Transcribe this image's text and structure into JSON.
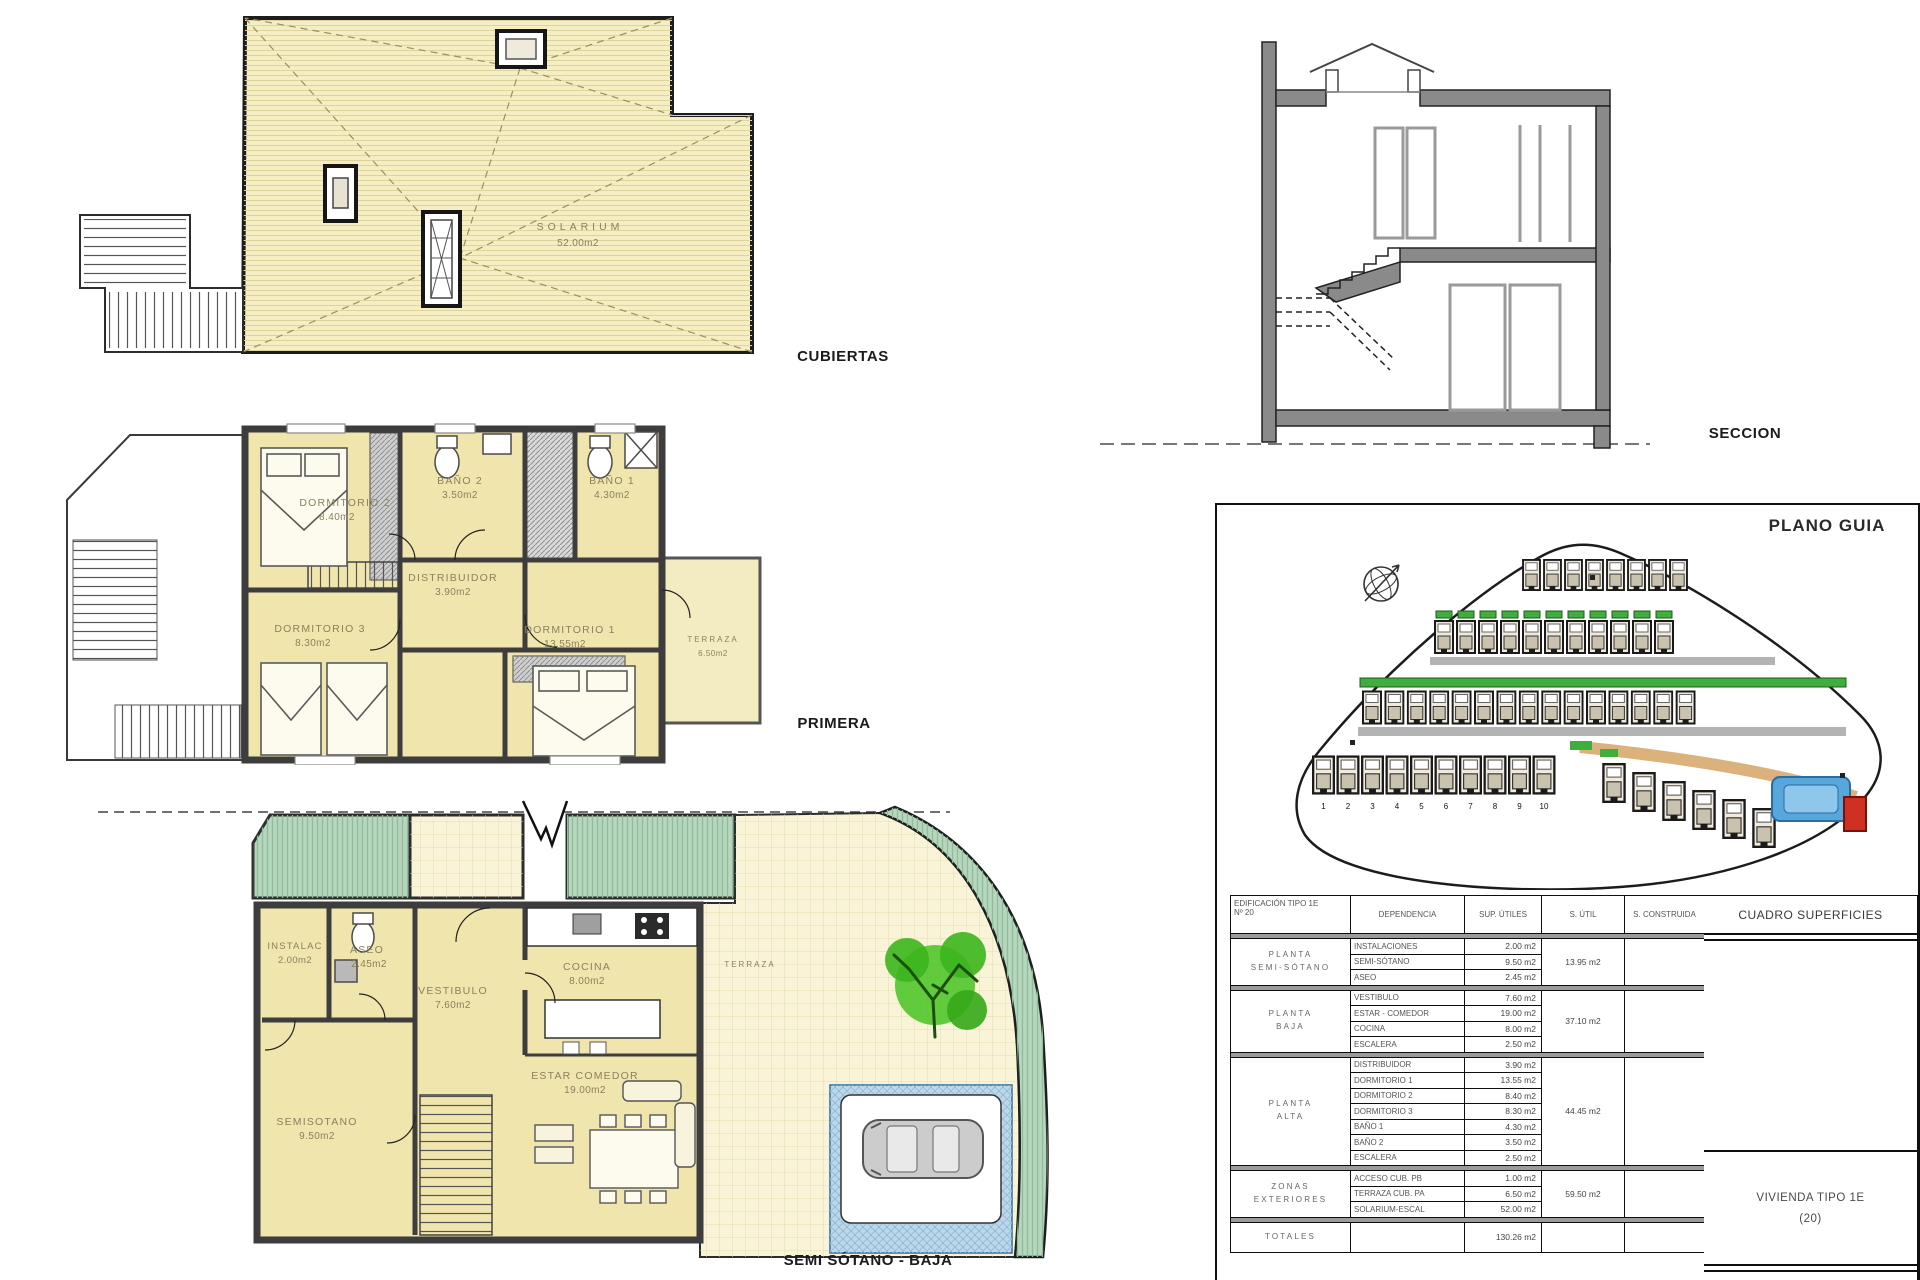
{
  "titles": {
    "cubiertas": "CUBIERTAS",
    "primera": "PRIMERA",
    "semi_sotano_baja": "SEMI SÓTANO - BAJA",
    "seccion": "SECCION",
    "plano_guia": "PLANO GUIA"
  },
  "roof_plan": {
    "solarium": {
      "name": "SOLARIUM",
      "area": "52.00m2"
    }
  },
  "first_floor": {
    "dormitorio2": {
      "name": "DORMITORIO 2",
      "area": "8.40m2"
    },
    "bano2": {
      "name": "BAÑO 2",
      "area": "3.50m2"
    },
    "bano1": {
      "name": "BAÑO 1",
      "area": "4.30m2"
    },
    "distribuidor": {
      "name": "DISTRIBUIDOR",
      "area": "3.90m2"
    },
    "dormitorio3": {
      "name": "DORMITORIO 3",
      "area": "8.30m2"
    },
    "dormitorio1": {
      "name": "DORMITORIO 1",
      "area": "13.55m2"
    },
    "terraza": {
      "name": "TERRAZA",
      "area": "6.50m2"
    }
  },
  "ground_floor": {
    "instalac": {
      "name": "INSTALAC",
      "area": "2.00m2"
    },
    "aseo": {
      "name": "ASEO",
      "area": "2.45m2"
    },
    "vestibulo": {
      "name": "VESTIBULO",
      "area": "7.60m2"
    },
    "cocina": {
      "name": "COCINA",
      "area": "8.00m2"
    },
    "estar_comedor": {
      "name": "ESTAR COMEDOR",
      "area": "19.00m2"
    },
    "semisotano": {
      "name": "SEMISOTANO",
      "area": "9.50m2"
    },
    "terraza": {
      "name": "TERRAZA"
    }
  },
  "site_plan": {
    "plot_numbers": [
      "1",
      "2",
      "3",
      "4",
      "5",
      "6",
      "7",
      "8",
      "9",
      "10"
    ]
  },
  "table": {
    "title": "CUADRO SUPERFICIES",
    "building_label": "EDIFICACIÓN TIPO 1E",
    "building_number": "Nº 20",
    "col_dependencia": "DEPENDENCIA",
    "col_sup_utiles": "SUP. ÚTILES",
    "col_s_util": "S. ÚTIL",
    "col_s_construida": "S. CONSTRUIDA",
    "sections": [
      {
        "label1": "PLANTA",
        "label2": "SEMI-SÓTANO",
        "s_util": "13.95 m2",
        "rows": [
          {
            "name": "INSTALACIONES",
            "value": "2.00 m2"
          },
          {
            "name": "SEMI-SÓTANO",
            "value": "9.50 m2"
          },
          {
            "name": "ASEO",
            "value": "2.45 m2"
          }
        ]
      },
      {
        "label1": "PLANTA",
        "label2": "BAJA",
        "s_util": "37.10 m2",
        "rows": [
          {
            "name": "VESTIBULO",
            "value": "7.60 m2"
          },
          {
            "name": "ESTAR - COMEDOR",
            "value": "19.00 m2"
          },
          {
            "name": "COCINA",
            "value": "8.00 m2"
          },
          {
            "name": "ESCALERA",
            "value": "2.50 m2"
          }
        ]
      },
      {
        "label1": "PLANTA",
        "label2": "ALTA",
        "s_util": "44.45 m2",
        "rows": [
          {
            "name": "DISTRIBUIDOR",
            "value": "3.90 m2"
          },
          {
            "name": "DORMITORIO 1",
            "value": "13.55 m2"
          },
          {
            "name": "DORMITORIO 2",
            "value": "8.40 m2"
          },
          {
            "name": "DORMITORIO 3",
            "value": "8.30 m2"
          },
          {
            "name": "BAÑO 1",
            "value": "4.30 m2"
          },
          {
            "name": "BAÑO 2",
            "value": "3.50 m2"
          },
          {
            "name": "ESCALERA",
            "value": "2.50 m2"
          }
        ]
      },
      {
        "label1": "ZONAS",
        "label2": "EXTERIORES",
        "s_util": "59.50 m2",
        "rows": [
          {
            "name": "ACCESO CUB. PB",
            "value": "1.00 m2"
          },
          {
            "name": "TERRAZA CUB. PA",
            "value": "6.50 m2"
          },
          {
            "name": "SOLARIUM-ESCAL",
            "value": "52.00 m2"
          }
        ]
      }
    ],
    "totales_label": "TOTALES",
    "totales_value": "130.26 m2",
    "vivienda_line1": "VIVIENDA TIPO 1E",
    "vivienda_line2": "(20)"
  }
}
